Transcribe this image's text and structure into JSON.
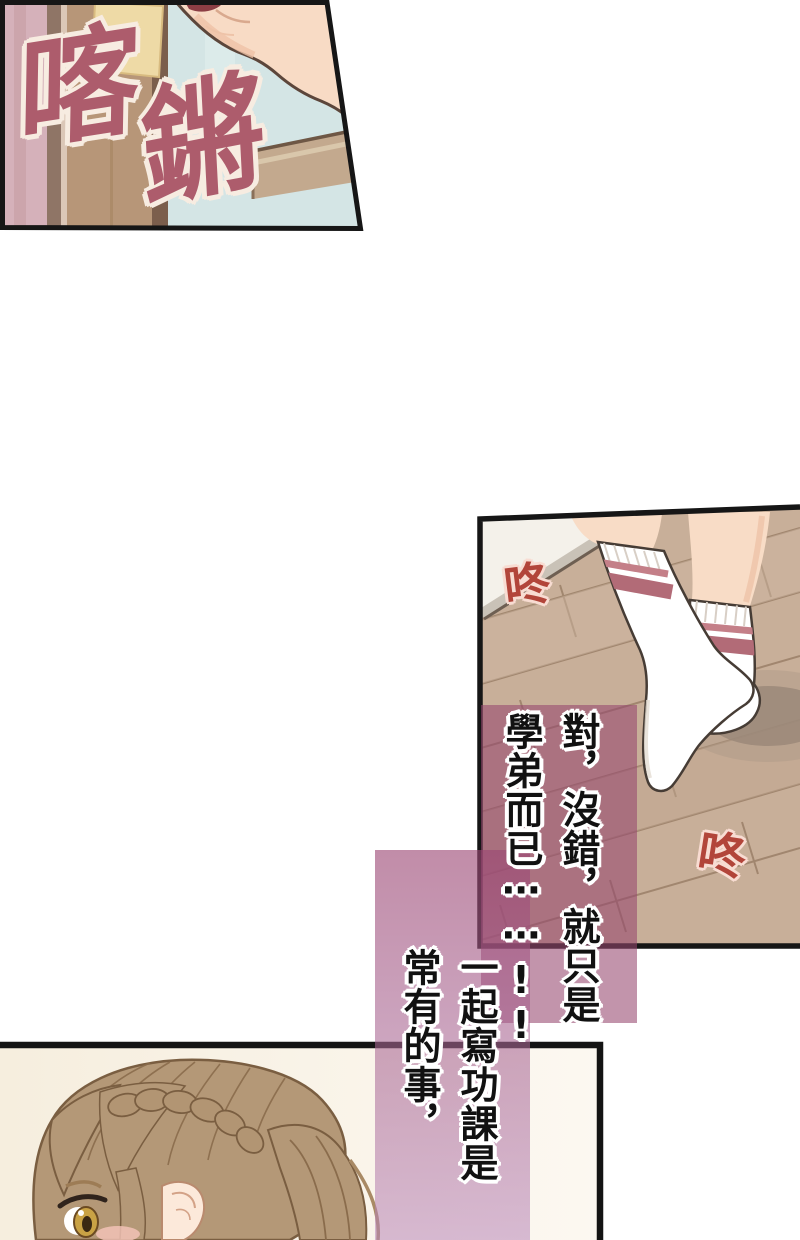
{
  "page": {
    "kind": "manhua webtoon strip segment",
    "background_color": "#ffffff",
    "width": 800,
    "height": 1240
  },
  "panels": {
    "doorway": {
      "description": "tilted panel of a door frame and raised arm seen close-up",
      "wall_pink": "#d5b1ba",
      "frame_dark": "#8f7566",
      "door_tan": "#b79678",
      "poster_yellow": "#eedaa6",
      "interior_blue": "#d4e5e5",
      "beam_tan": "#c3a98e",
      "skin": "#f8dbc5"
    },
    "floor_socks": {
      "description": "legs in white socks with rose stripes walking across a wood plank floor",
      "wall_white": "#f4f1ea",
      "baseboard_grey": "#c9c2b7",
      "floor_tan": "#c8af99",
      "plank_line": "#9b8068",
      "sock_white": "#ffffff",
      "sock_stripe_thick": "#b26b77",
      "sock_stripe_thin": "#c47f88",
      "skin": "#f8dcc6",
      "shadow": "#9b8879"
    },
    "girl": {
      "description": "profile of a girl with brown bangs, crown braid and side ponytail",
      "background_cream": "#f6eede",
      "hair_brown": "#b49877",
      "hair_line": "#7a5e41",
      "skin": "#fce9da",
      "iris_gold": "#c9a245",
      "blush": "#f6c6ba",
      "border_black": "#141414"
    }
  },
  "sfx": {
    "clack": {
      "text": "喀",
      "color": "#ad5c6c",
      "outline": "#f7ece1"
    },
    "clang": {
      "text": "鏘",
      "color": "#ad5c6c",
      "outline": "#f7ece1"
    },
    "thud_1": {
      "text": "咚",
      "color": "#b2453a",
      "outline": "#f8dcd2"
    },
    "thud_2": {
      "text": "咚",
      "color": "#b2453a",
      "outline": "#f8dcd2"
    }
  },
  "thoughts": {
    "monologue_1": {
      "full_text": "對，沒錯，就只是學弟而已⋯⋯!!",
      "column_right": "對，沒錯，就只是",
      "column_left": "學弟而已⋯⋯!!",
      "text_color": "#111111",
      "overlay_color_hex": "#c294ab"
    },
    "monologue_2": {
      "full_text": "一起寫功課是常有的事，",
      "column_right": "一起寫功課是",
      "column_left": "常有的事，",
      "text_color": "#111111",
      "overlay_color_top_hex": "#c18ca8",
      "overlay_color_bottom_hex": "#d9bdd9"
    }
  }
}
